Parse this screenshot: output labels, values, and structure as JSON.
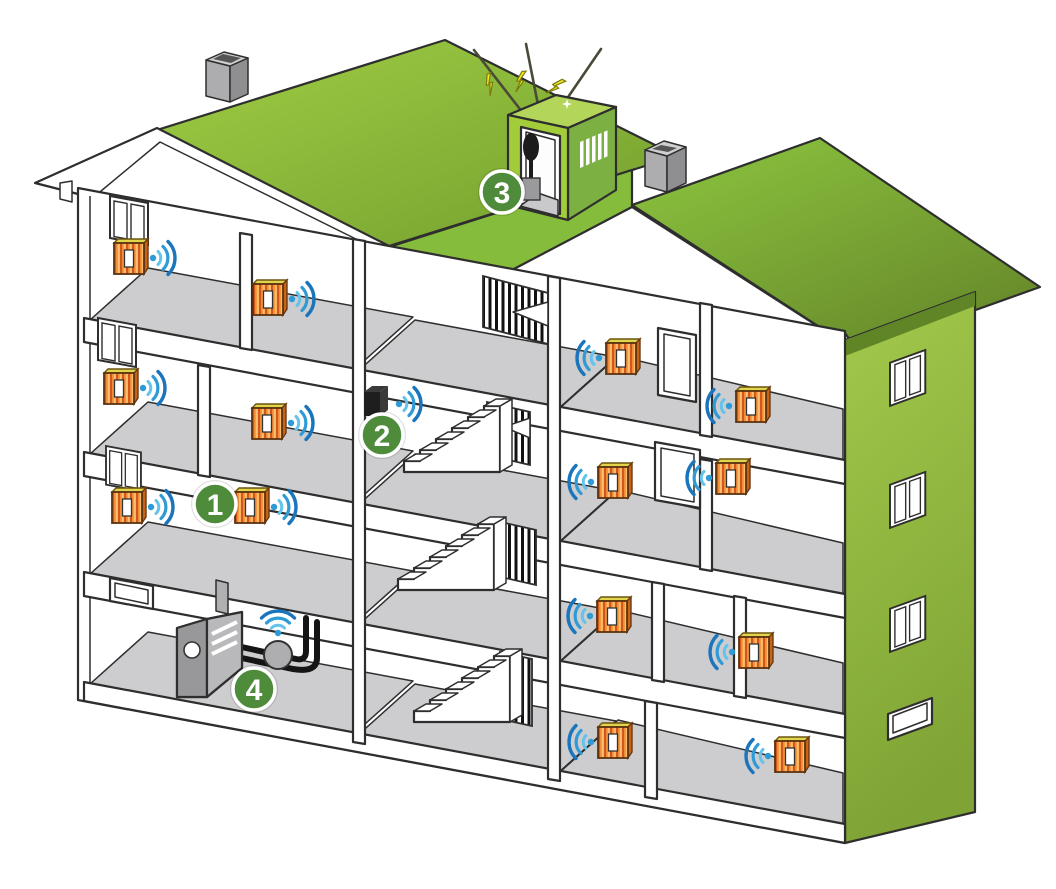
{
  "diagram": {
    "type": "building-cutaway-wireless-heat-metering",
    "markers": [
      {
        "label": "1",
        "attached_to": "radiator-transmitter"
      },
      {
        "label": "2",
        "attached_to": "wall-transmitter"
      },
      {
        "label": "3",
        "attached_to": "rooftop-antenna-gateway"
      },
      {
        "label": "4",
        "attached_to": "boiler-heat-meter"
      }
    ],
    "counts": {
      "radiators_with_wifi": 14,
      "floors": 4,
      "staircases": 3,
      "chimneys": 2
    }
  },
  "icons": {
    "marker": "numbered-hotspot-badge",
    "wifi": "wifi-signal-icon",
    "radiator": "radiator-icon",
    "boiler": "boiler-icon",
    "heat_meter": "heat-meter-icon",
    "antenna": "antenna-icon",
    "lightning": "lightning-bolt-icon",
    "chimney": "chimney-icon",
    "stairs": "staircase-icon",
    "window": "window-icon",
    "device": "wall-transmitter-icon"
  },
  "colors": {
    "outline": "#2e2e2e",
    "roof-green": "#8dc63f",
    "roof-green-dark": "#6e9a2e",
    "wall-green": "#96c23d",
    "wall-shadow": "#5f8527",
    "penthouse-green": "#a2cc3a",
    "penthouse-green-dark": "#7cb043",
    "marker-green": "#4e8c3c",
    "floor-grey": "#cdcdcf",
    "radiator-orange": "#f79a3c",
    "radiator-stripe": "#d2571c",
    "radiator-top": "#e2d44b",
    "wifi-light": "#63c3ec",
    "wifi-dark": "#1b75bc",
    "bolt-yellow": "#f5eb1f",
    "device-black": "#1e1e1e",
    "boiler-grey": "#a0a0a2",
    "pipe-black": "#151515",
    "chimney-grey": "#b0b0b2"
  }
}
